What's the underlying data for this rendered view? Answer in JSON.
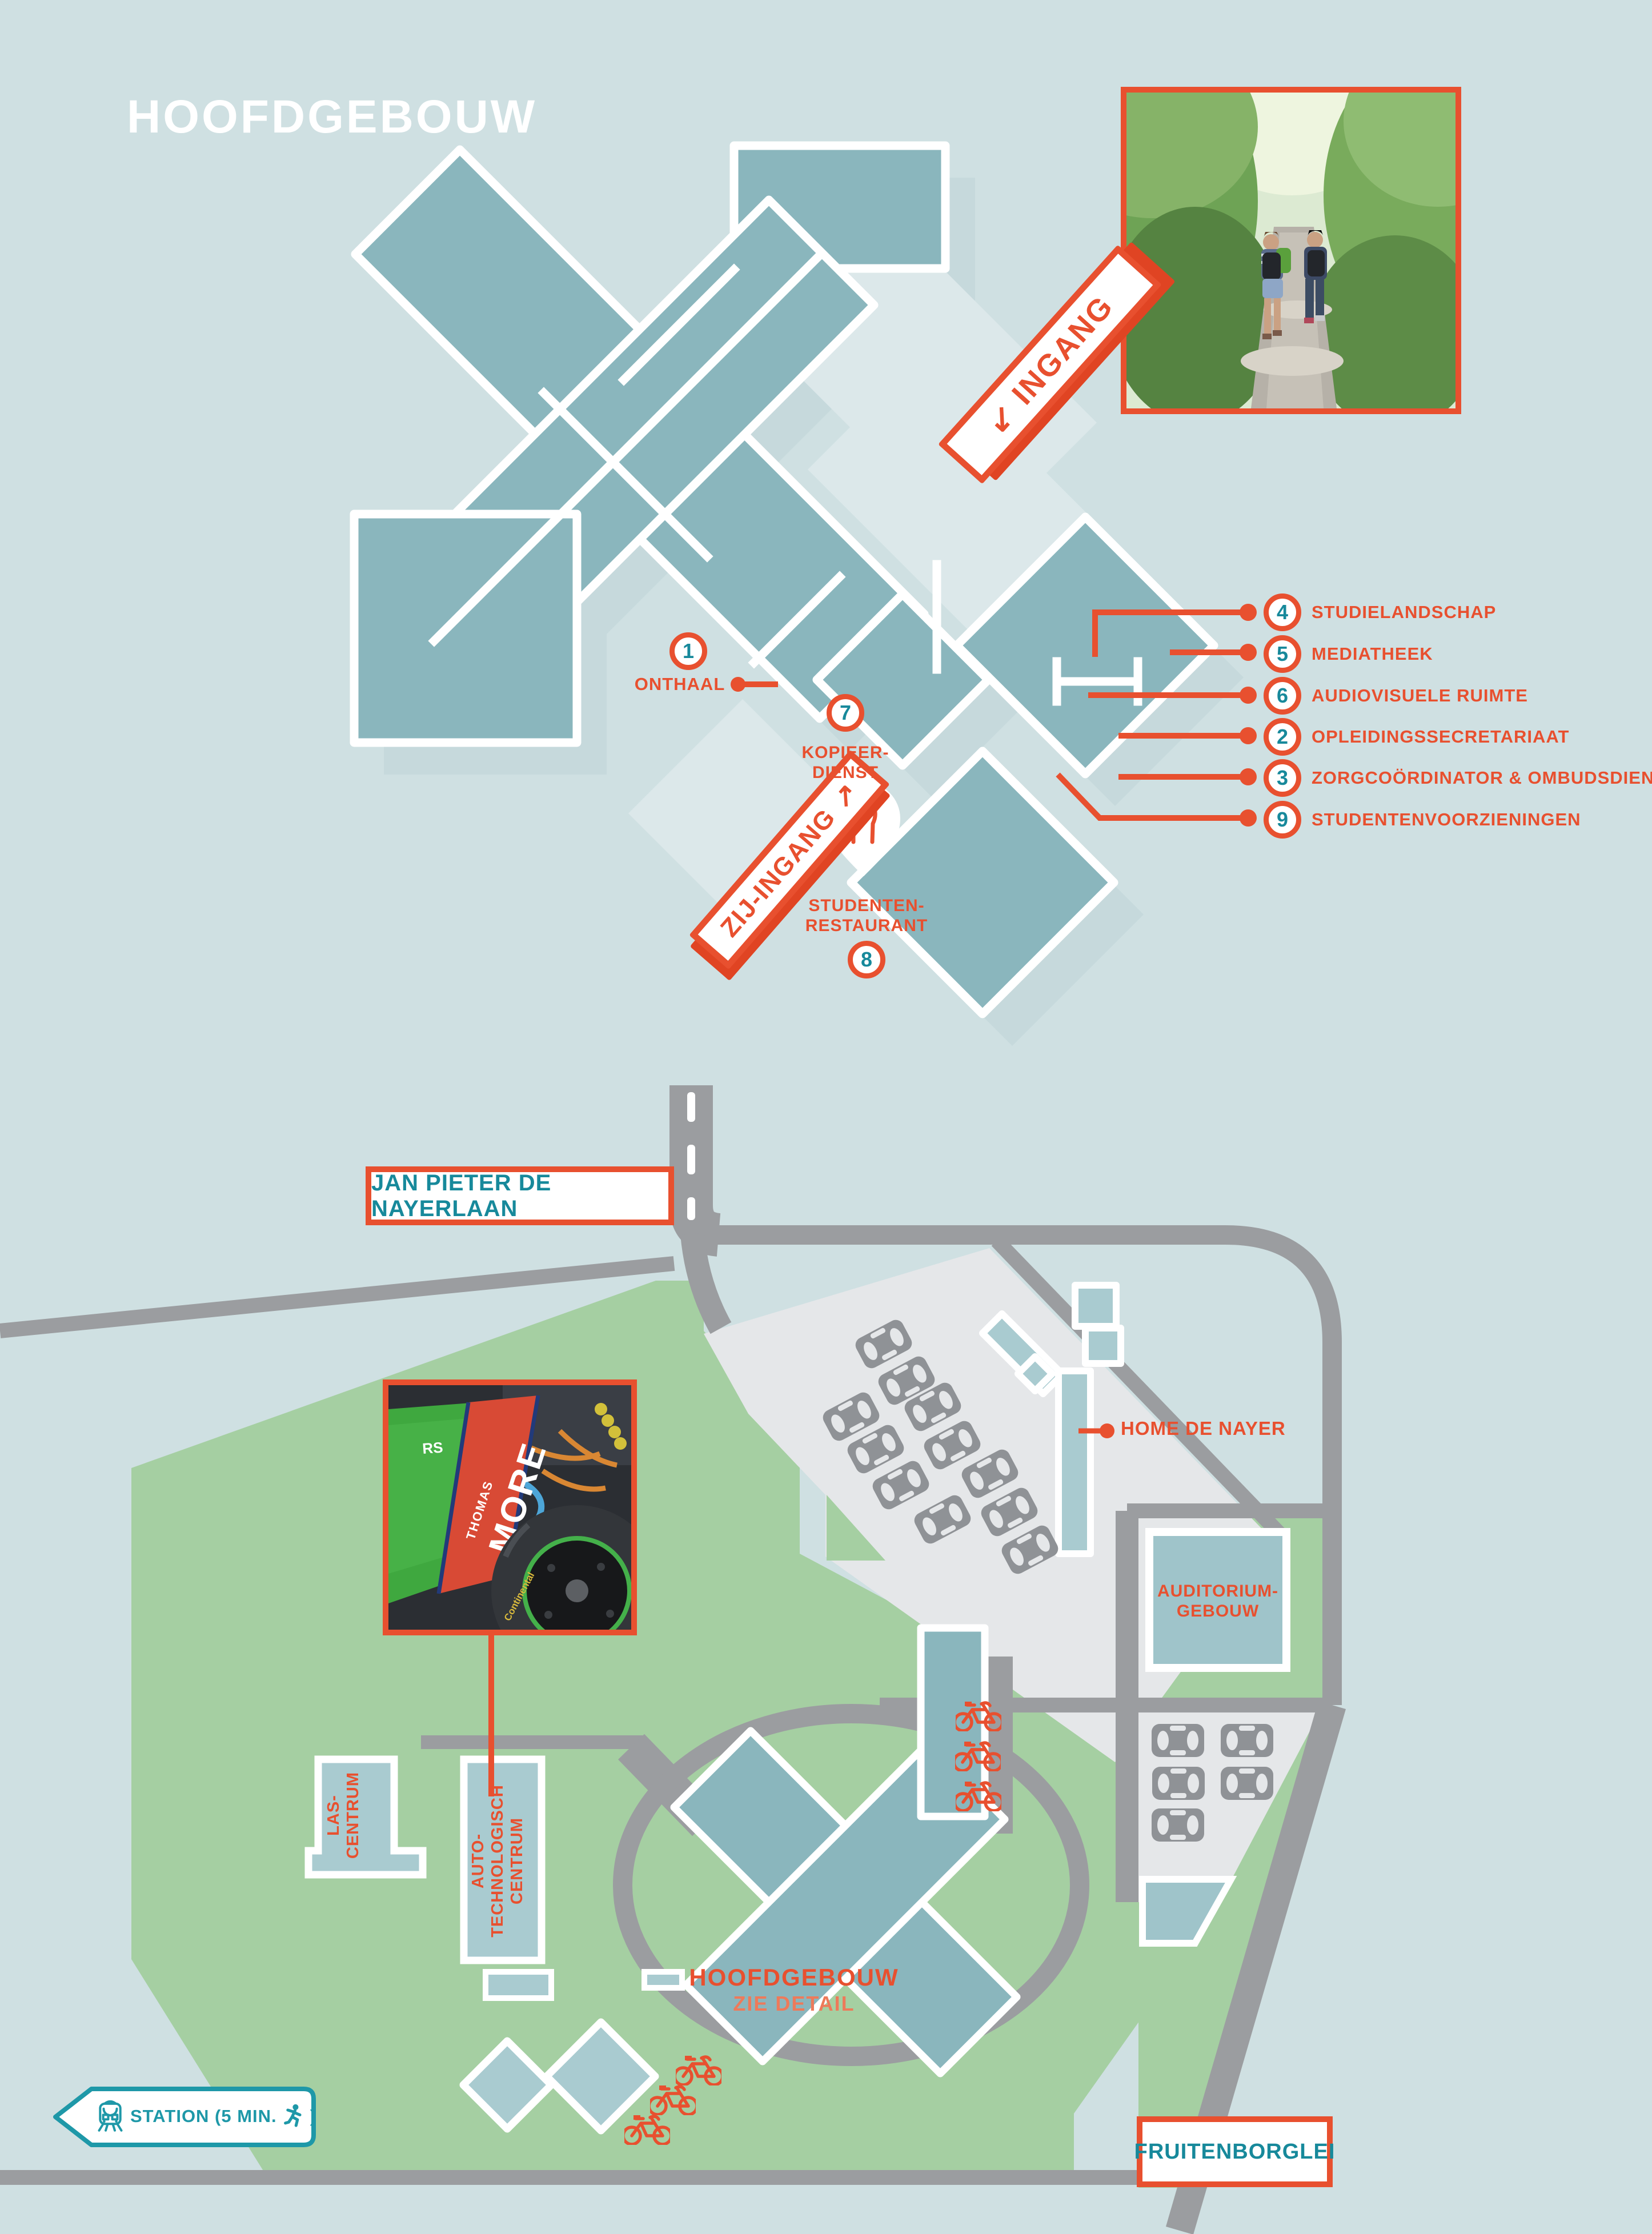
{
  "title": "HOOFDGEBOUW",
  "floorplan": {
    "ingang": "INGANG",
    "ingang_arrow": "↙",
    "zij_ingang": "ZIJ-INGANG",
    "zij_ingang_arrow": "↗",
    "onthaal": {
      "num": "1",
      "label": "ONTHAAL"
    },
    "kopieerdienst": {
      "num": "7",
      "line1": "KOPIEER-",
      "line2": "DIENST"
    },
    "restaurant": {
      "num": "8",
      "line1": "STUDENTEN-",
      "line2": "RESTAURANT"
    },
    "legend": [
      {
        "num": "4",
        "label": "STUDIELANDSCHAP"
      },
      {
        "num": "5",
        "label": "MEDIATHEEK"
      },
      {
        "num": "6",
        "label": "AUDIOVISUELE RUIMTE"
      },
      {
        "num": "2",
        "label": "OPLEIDINGSSECRETARIAAT"
      },
      {
        "num": "3",
        "label": "ZORGCOÖRDINATOR & OMBUDSDIENST"
      },
      {
        "num": "9",
        "label": "STUDENTENVOORZIENINGEN"
      }
    ]
  },
  "map": {
    "street_top": "JAN PIETER DE NAYERLAAN",
    "street_bottom": "FRUITENBORGLEI",
    "home_de_nayer": "HOME DE NAYER",
    "auditorium": {
      "line1": "AUDITORIUM-",
      "line2": "GEBOUW"
    },
    "las_centrum": {
      "line1": "LAS-",
      "line2": "CENTRUM"
    },
    "auto_technologisch_centrum": {
      "line1": "AUTO-",
      "line2": "TECHNOLOGISCH",
      "line3": "CENTRUM"
    },
    "hoofdgebouw_label": {
      "line1": "HOOFDGEBOUW",
      "line2": "ZIE DETAIL"
    },
    "station_sign": {
      "text": "STATION (5 MIN.",
      "suffix": ")"
    }
  },
  "photos": {
    "racecar": {
      "line1": "THOMAS",
      "line2": "MORE",
      "badge": "RS"
    }
  },
  "colors": {
    "orange": "#e8502f",
    "orange_light": "#ee7a5a",
    "teal_text": "#17899b",
    "building_teal": "#8ab6bd",
    "building_shadow": "#c6d9dc",
    "pale_panel": "#dce8ea",
    "light_building": "#a9cbd0",
    "green": "#a5cfa2",
    "road_gray": "#9b9da0",
    "parking_gray": "#e5e7e9",
    "car_gray": "#8f9296",
    "background": "#cfe0e2",
    "station_teal": "#1e98a8"
  }
}
